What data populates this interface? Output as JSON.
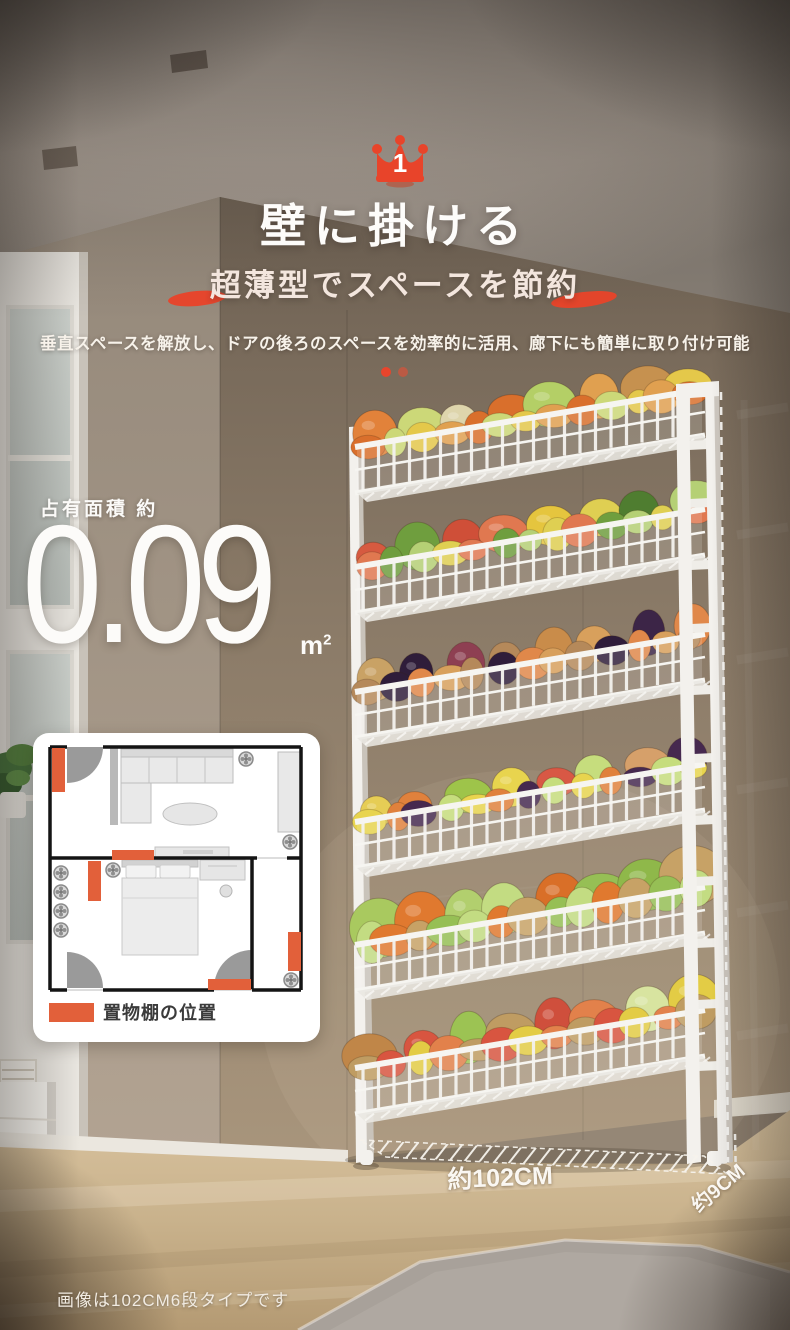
{
  "badge": {
    "rank": "1"
  },
  "header": {
    "title": "壁に掛ける",
    "subtitle": "超薄型でスペースを節約",
    "description": "垂直スペースを解放し、ドアの後ろのスペースを効率的に活用、廊下にも簡単に取り付け可能"
  },
  "carousel": {
    "dot_colors": [
      "#e8452c",
      "#bb5a44"
    ]
  },
  "area": {
    "label": "占有面積 約",
    "value": "0.09",
    "unit_base": "m",
    "unit_sup": "2"
  },
  "floorplan": {
    "legend_label": "置物棚の位置",
    "legend_color": "#e2603a",
    "legend_style": "background:#e2603a"
  },
  "dimensions": {
    "width_label": "約102CM",
    "depth_label": "约9CM"
  },
  "caption": {
    "text": "画像は102CM6段タイプです"
  },
  "colors": {
    "accent": "#e8442a",
    "accent_dim": "#bb5a44",
    "legend_orange": "#e2603a",
    "rack_white": "#f3f1ed"
  },
  "rack": {
    "tier_count": 6,
    "tiers": [
      {
        "name": "carrots-onions-corn-greens",
        "scale": 1.0,
        "colors": [
          "#e2823a",
          "#d96f2c",
          "#c6914f",
          "#ccd878",
          "#b4cf66",
          "#e4c84a",
          "#ded5ac",
          "#e0a050"
        ]
      },
      {
        "name": "apples-cucumbers-corn-cabbage",
        "scale": 1.0,
        "colors": [
          "#d65a40",
          "#e07850",
          "#4f7d30",
          "#6f9e3e",
          "#e5c53e",
          "#b5d075",
          "#cf4f38",
          "#dfcf52"
        ]
      },
      {
        "name": "potatoes-eggplant-onions-oranges",
        "scale": 1.0,
        "colors": [
          "#c9a265",
          "#b5895a",
          "#3c2547",
          "#2f1d3a",
          "#c98c4a",
          "#e0884a",
          "#8e3f52",
          "#d8a05c"
        ]
      },
      {
        "name": "bananas-lemons-peaches-plums",
        "scale": 0.95,
        "colors": [
          "#e6cd55",
          "#e8d44e",
          "#d6a06a",
          "#e0813c",
          "#d85845",
          "#46294f",
          "#9ec44a",
          "#c6dd7d"
        ]
      },
      {
        "name": "cabbages-carrots-potatoes",
        "scale": 1.25,
        "colors": [
          "#a9c95f",
          "#c3dc82",
          "#8fb84a",
          "#e0792f",
          "#d96f28",
          "#c7a266",
          "#b2cf6e",
          "#96bf55"
        ]
      },
      {
        "name": "onions-napa-tomatoes-citrus",
        "scale": 1.1,
        "colors": [
          "#c08648",
          "#bf9c62",
          "#d8e4a0",
          "#d85540",
          "#cf4f3c",
          "#e3cc45",
          "#9cc353",
          "#e2814b"
        ]
      }
    ]
  }
}
